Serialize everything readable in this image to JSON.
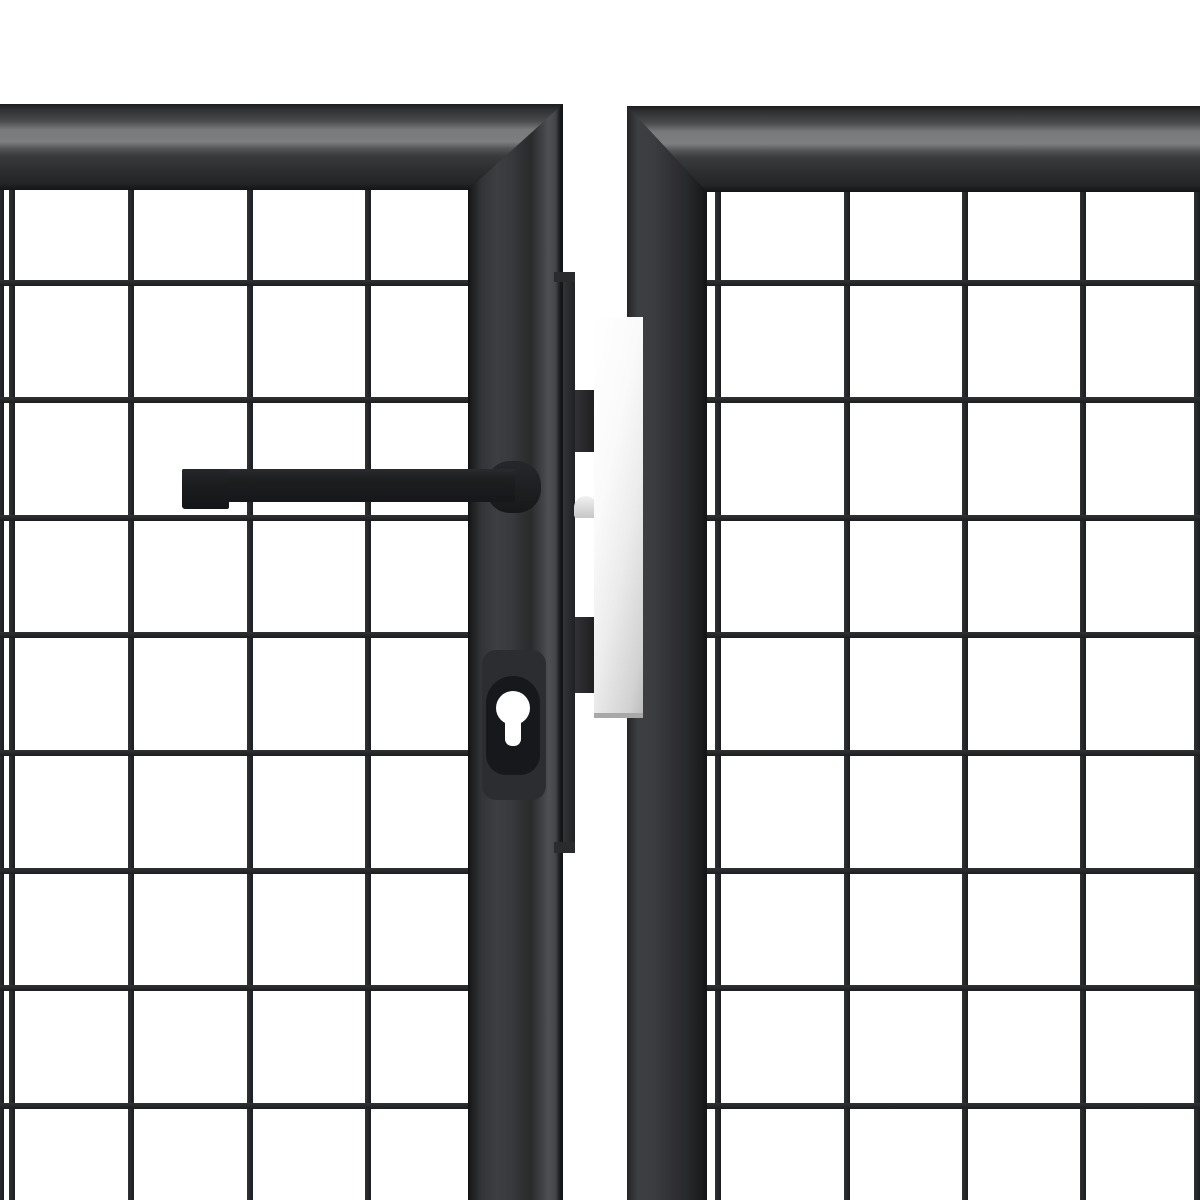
{
  "photo": {
    "width": 1200,
    "height": 1200,
    "background": "#ffffff",
    "subject": "Close-up of anthracite steel mesh garden gate: double-door lock area with lever handle, euro-profile cylinder keyhole and stainless latch plate"
  },
  "palette": {
    "background_white": "#ffffff",
    "frame_dark_edge": "#141517",
    "frame_face": "#36373a",
    "frame_highlight_stripe": "#7d7e80",
    "stile_bright_band": "#4f5053",
    "mesh_wire": "#232427",
    "hardware_black": "#1d1e20",
    "latch_plate_light": "#ffffff",
    "latch_plate_dark": "#c2c2c2"
  },
  "left_panel": {
    "mesh": {
      "area": {
        "x": 0,
        "y": 190,
        "w": 474,
        "h": 1010
      },
      "wire": 6,
      "vertical_x": [
        1,
        12,
        131,
        250,
        368
      ],
      "horizontal_y": [
        283,
        400,
        518,
        635,
        753,
        871,
        988,
        1106
      ],
      "fill_v": "linear-gradient(to right, #303134, #1c1d1f)",
      "fill_h": "linear-gradient(to bottom, #303134, #1c1d1f)"
    },
    "top_rail": {
      "x": 0,
      "y": 104,
      "w": 563,
      "h": 86,
      "fill": "linear-gradient(to bottom, #1b1c1e 0%, #2e2f31 6%, #4a4b4d 20%, #797a7c 30%, #7d7e80 44%, #535456 52%, #3a3b3d 60%, #2c2d2f 78%, #242527 92%, #131416 100%)"
    },
    "stile": {
      "x": 468,
      "y": 104,
      "w": 95,
      "h": 1096,
      "clip": "polygon(0 86px, 100% 0, 100% 100%, 0 100%)",
      "fill": "linear-gradient(to right, #101113 0%, #1d1e20 4%, #333437 14%, #3d3e41 30%, #383a3d 45%, #2e2f31 58%, #2a2b2d 66%, #3c3d40 76%, #4f5053 85%, #45464a 92%, #191a1c 97%, #121315 100%)"
    }
  },
  "right_panel": {
    "mesh": {
      "area": {
        "x": 703,
        "y": 192,
        "w": 497,
        "h": 1008
      },
      "wire": 6,
      "vertical_x": [
        718,
        847,
        965,
        1083,
        1197
      ],
      "horizontal_y": [
        283,
        400,
        518,
        635,
        753,
        871,
        988,
        1106
      ],
      "fill_v": "linear-gradient(to right, #303134, #1c1d1f)",
      "fill_h": "linear-gradient(to bottom, #303134, #1c1d1f)"
    },
    "top_rail": {
      "x": 627,
      "y": 106,
      "w": 573,
      "h": 86,
      "fill": "linear-gradient(to bottom, #1b1c1e 0%, #2e2f31 6%, #4a4b4d 20%, #797a7c 30%, #7d7e80 44%, #535456 52%, #3a3b3d 60%, #2c2d2f 78%, #242527 92%, #131416 100%)"
    },
    "stile": {
      "x": 627,
      "y": 106,
      "w": 80,
      "h": 1094,
      "clip": "polygon(0 0, 100% 86px, 100% 100%, 0 100%)",
      "fill": "linear-gradient(to right, #25262a 0%, #3e3f42 14%, #3b3c3f 34%, #303134 56%, #27282b 76%, #1d1e20 90%, #131416 100%)"
    }
  },
  "center_hardware": {
    "keeper_strip": {
      "x": 563,
      "y": 272,
      "w": 12,
      "h": 581,
      "fill": "linear-gradient(to right, #333437, #202124)"
    },
    "strip_cap_top": {
      "x": 554,
      "y": 272,
      "w": 21,
      "h": 10,
      "fill": "#2a2b2d"
    },
    "strip_cap_bottom": {
      "x": 554,
      "y": 842,
      "w": 21,
      "h": 11,
      "fill": "#2a2b2d"
    },
    "latch_tab_upper": {
      "x": 575,
      "y": 390,
      "w": 19,
      "h": 62,
      "fill": "linear-gradient(to right, #313236, #1e1f21)"
    },
    "latch_tab_lower": {
      "x": 575,
      "y": 617,
      "w": 19,
      "h": 76,
      "fill": "linear-gradient(to right, #313236, #1e1f21)"
    },
    "latch_bolt": {
      "x": 574,
      "y": 496,
      "w": 23,
      "h": 22,
      "radius": "12px 12px 3px 3px",
      "fill": "linear-gradient(to bottom, #f2f2f2, #c6c6c6)"
    },
    "latch_plate": {
      "x": 594,
      "y": 317,
      "w": 49,
      "h": 401,
      "fill": "linear-gradient(102deg, #ffffff 0%, #fafafa 35%, #ececec 60%, #d2d2d2 88%, #bcbcbc 100%)"
    },
    "latch_plate_bottom_edge": {
      "x": 594,
      "y": 713,
      "w": 49,
      "h": 5,
      "fill": "#a8a8a8"
    }
  },
  "handle_assembly": {
    "backplate": {
      "x": 482,
      "y": 650,
      "w": 64,
      "h": 150,
      "radius": "14px",
      "fill": "#2c2d30"
    },
    "neck": {
      "x": 486,
      "y": 461,
      "w": 55,
      "h": 52,
      "radius": "24px",
      "fill": "linear-gradient(to bottom, #26272a, #17181a)"
    },
    "bar": {
      "x": 182,
      "y": 469,
      "w": 333,
      "h": 33,
      "radius": "2px",
      "fill": "linear-gradient(to bottom, #2a2b2e 0%, #1d1e20 30%, #16171a 100%)"
    },
    "end_cap": {
      "x": 182,
      "y": 469,
      "w": 47,
      "h": 40,
      "radius": "2px 0 2px 3px",
      "fill": "linear-gradient(to bottom, #26272a 0%, #1b1c1e 40%, #141518 100%)"
    },
    "keyhole_recess": {
      "x": 486,
      "y": 676,
      "w": 54,
      "h": 99,
      "radius": "27px 27px 20px 20px",
      "fill": "#17181b"
    },
    "keyhole_hole_circle": {
      "x": 496,
      "y": 691,
      "w": 34,
      "h": 34,
      "radius": "50%",
      "fill": "#ffffff"
    },
    "keyhole_hole_slot": {
      "x": 505,
      "y": 712,
      "w": 16,
      "h": 34,
      "radius": "2px 2px 7px 7px",
      "fill": "#ffffff"
    }
  }
}
